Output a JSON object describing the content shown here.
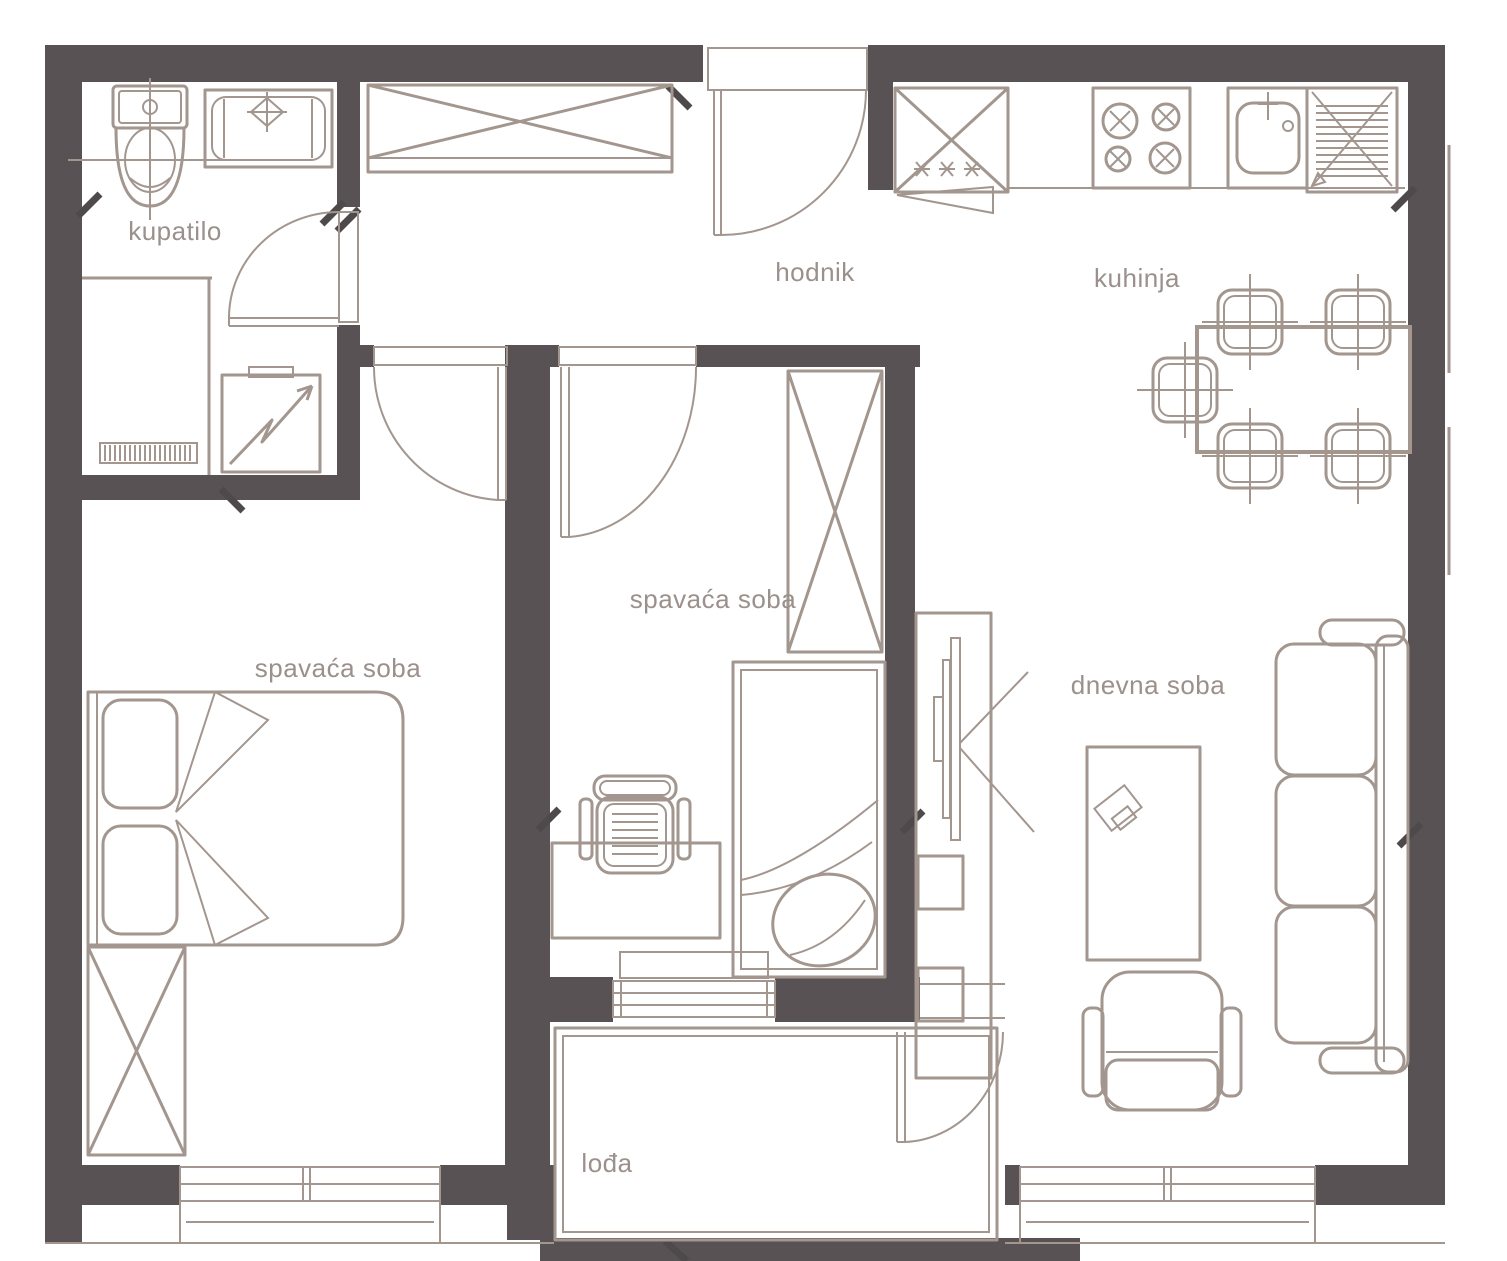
{
  "plan": {
    "type": "apartment-floor-plan",
    "background": "#ffffff",
    "colors": {
      "wall": "#585254",
      "line": "#a2968f",
      "text": "#9b908b",
      "tick": "#4e494b"
    },
    "rooms": [
      {
        "id": "kupatilo",
        "label": "kupatilo"
      },
      {
        "id": "hodnik",
        "label": "hodnik"
      },
      {
        "id": "kuhinja",
        "label": "kuhinja"
      },
      {
        "id": "spavaca-soba-2",
        "label": "spavaća soba"
      },
      {
        "id": "spavaca-soba-1",
        "label": "spavaća soba"
      },
      {
        "id": "dnevna-soba",
        "label": "dnevna soba"
      },
      {
        "id": "lodja",
        "label": "lođa"
      }
    ],
    "furniture": [
      "toilet",
      "bathtub",
      "radiator",
      "washing-machine",
      "hall-wardrobe",
      "fridge-freezer",
      "stove",
      "kitchen-sink",
      "dishwasher",
      "dining-table",
      "dining-chairs",
      "double-bed",
      "wardrobe",
      "tall-wardrobe",
      "single-bed",
      "desk",
      "desk-chair",
      "tv-cabinet",
      "coffee-table",
      "sofa",
      "armchair"
    ]
  }
}
